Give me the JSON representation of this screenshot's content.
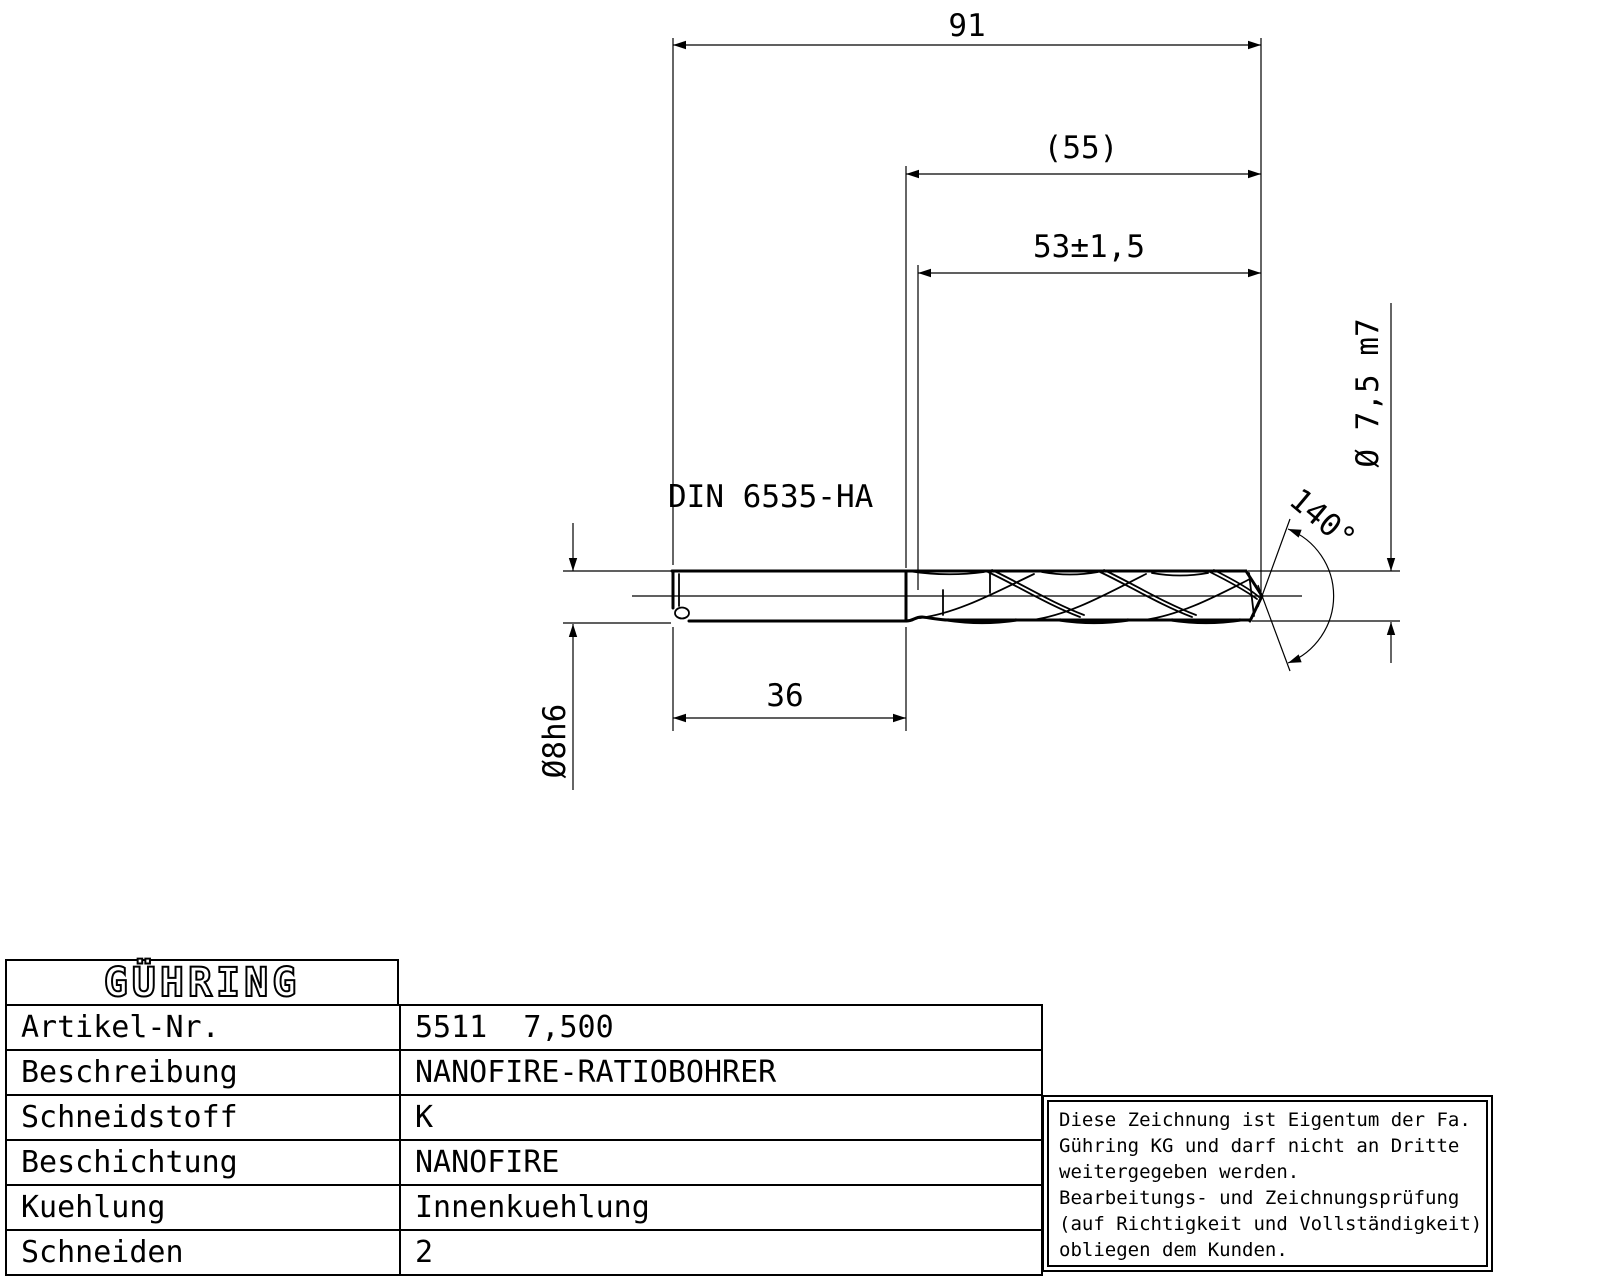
{
  "drawing": {
    "dim_overall_length": "91",
    "dim_flute_ref_length": "(55)",
    "dim_flute_length": "53±1,5",
    "dim_shank_length": "36",
    "dim_shank_diameter": "Ø8h6",
    "dim_drill_diameter": "Ø 7,5 m7",
    "dim_point_angle": "140°",
    "shank_standard": "DIN 6535-HA"
  },
  "title_block": {
    "logo_text": "GÜHRING",
    "rows": [
      {
        "label": "Artikel-Nr.",
        "value": "5511  7,500"
      },
      {
        "label": "Beschreibung",
        "value": "NANOFIRE-RATIOBOHRER"
      },
      {
        "label": "Schneidstoff",
        "value": "K"
      },
      {
        "label": "Beschichtung",
        "value": "NANOFIRE"
      },
      {
        "label": "Kuehlung",
        "value": "Innenkuehlung"
      },
      {
        "label": "Schneiden",
        "value": "2"
      }
    ]
  },
  "notice": {
    "lines": [
      "Diese Zeichnung ist Eigentum der Fa.",
      "Gühring KG und darf nicht an Dritte",
      "weitergegeben werden.",
      "Bearbeitungs- und Zeichnungsprüfung",
      "(auf Richtigkeit und Vollständigkeit)",
      "obliegen dem Kunden."
    ]
  },
  "colors": {
    "line": "#000000",
    "background": "#ffffff"
  }
}
